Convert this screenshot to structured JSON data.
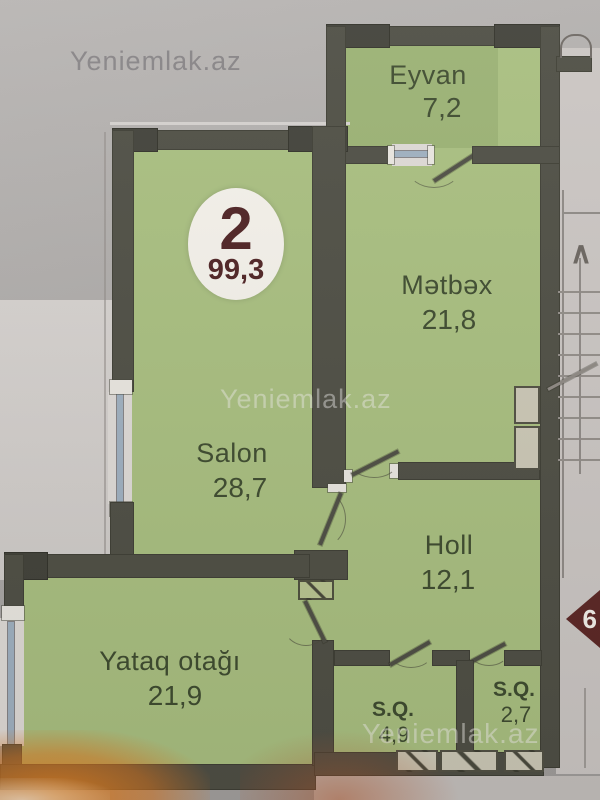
{
  "watermarks": {
    "top": "Yeniemlak.az",
    "middle": "Yeniemlak.az",
    "bottom": "Yeniemlak.az"
  },
  "unit_badge": {
    "number": "2",
    "total_area": "99,3"
  },
  "floor_marker": {
    "label": "6"
  },
  "stairs": {
    "arrow": "∧"
  },
  "rooms": {
    "eyvan": {
      "name": "Eyvan",
      "area": "7,2"
    },
    "metbex": {
      "name": "Mətbəx",
      "area": "21,8"
    },
    "salon": {
      "name": "Salon",
      "area": "28,7"
    },
    "holl": {
      "name": "Holl",
      "area": "12,1"
    },
    "yataq": {
      "name": "Yataq otağı",
      "area": "21,9"
    },
    "sq_large": {
      "name": "S.Q.",
      "area": "4,9"
    },
    "sq_small": {
      "name": "S.Q.",
      "area": "2,7"
    }
  },
  "colors": {
    "bg-top": "#b8b5b3",
    "bg-bottom": "#9f9c9a",
    "room-green": "#a9bf80",
    "wall": "#4f4f45",
    "wall-dark": "#42423a",
    "label": "#3f4c30",
    "badge-bg": "#f4f1ea",
    "badge-text": "#4f2324",
    "marker": "#5c2725",
    "window": "#9fb0c0",
    "exterior": "#cbc6c3",
    "flash": "#de7820"
  }
}
